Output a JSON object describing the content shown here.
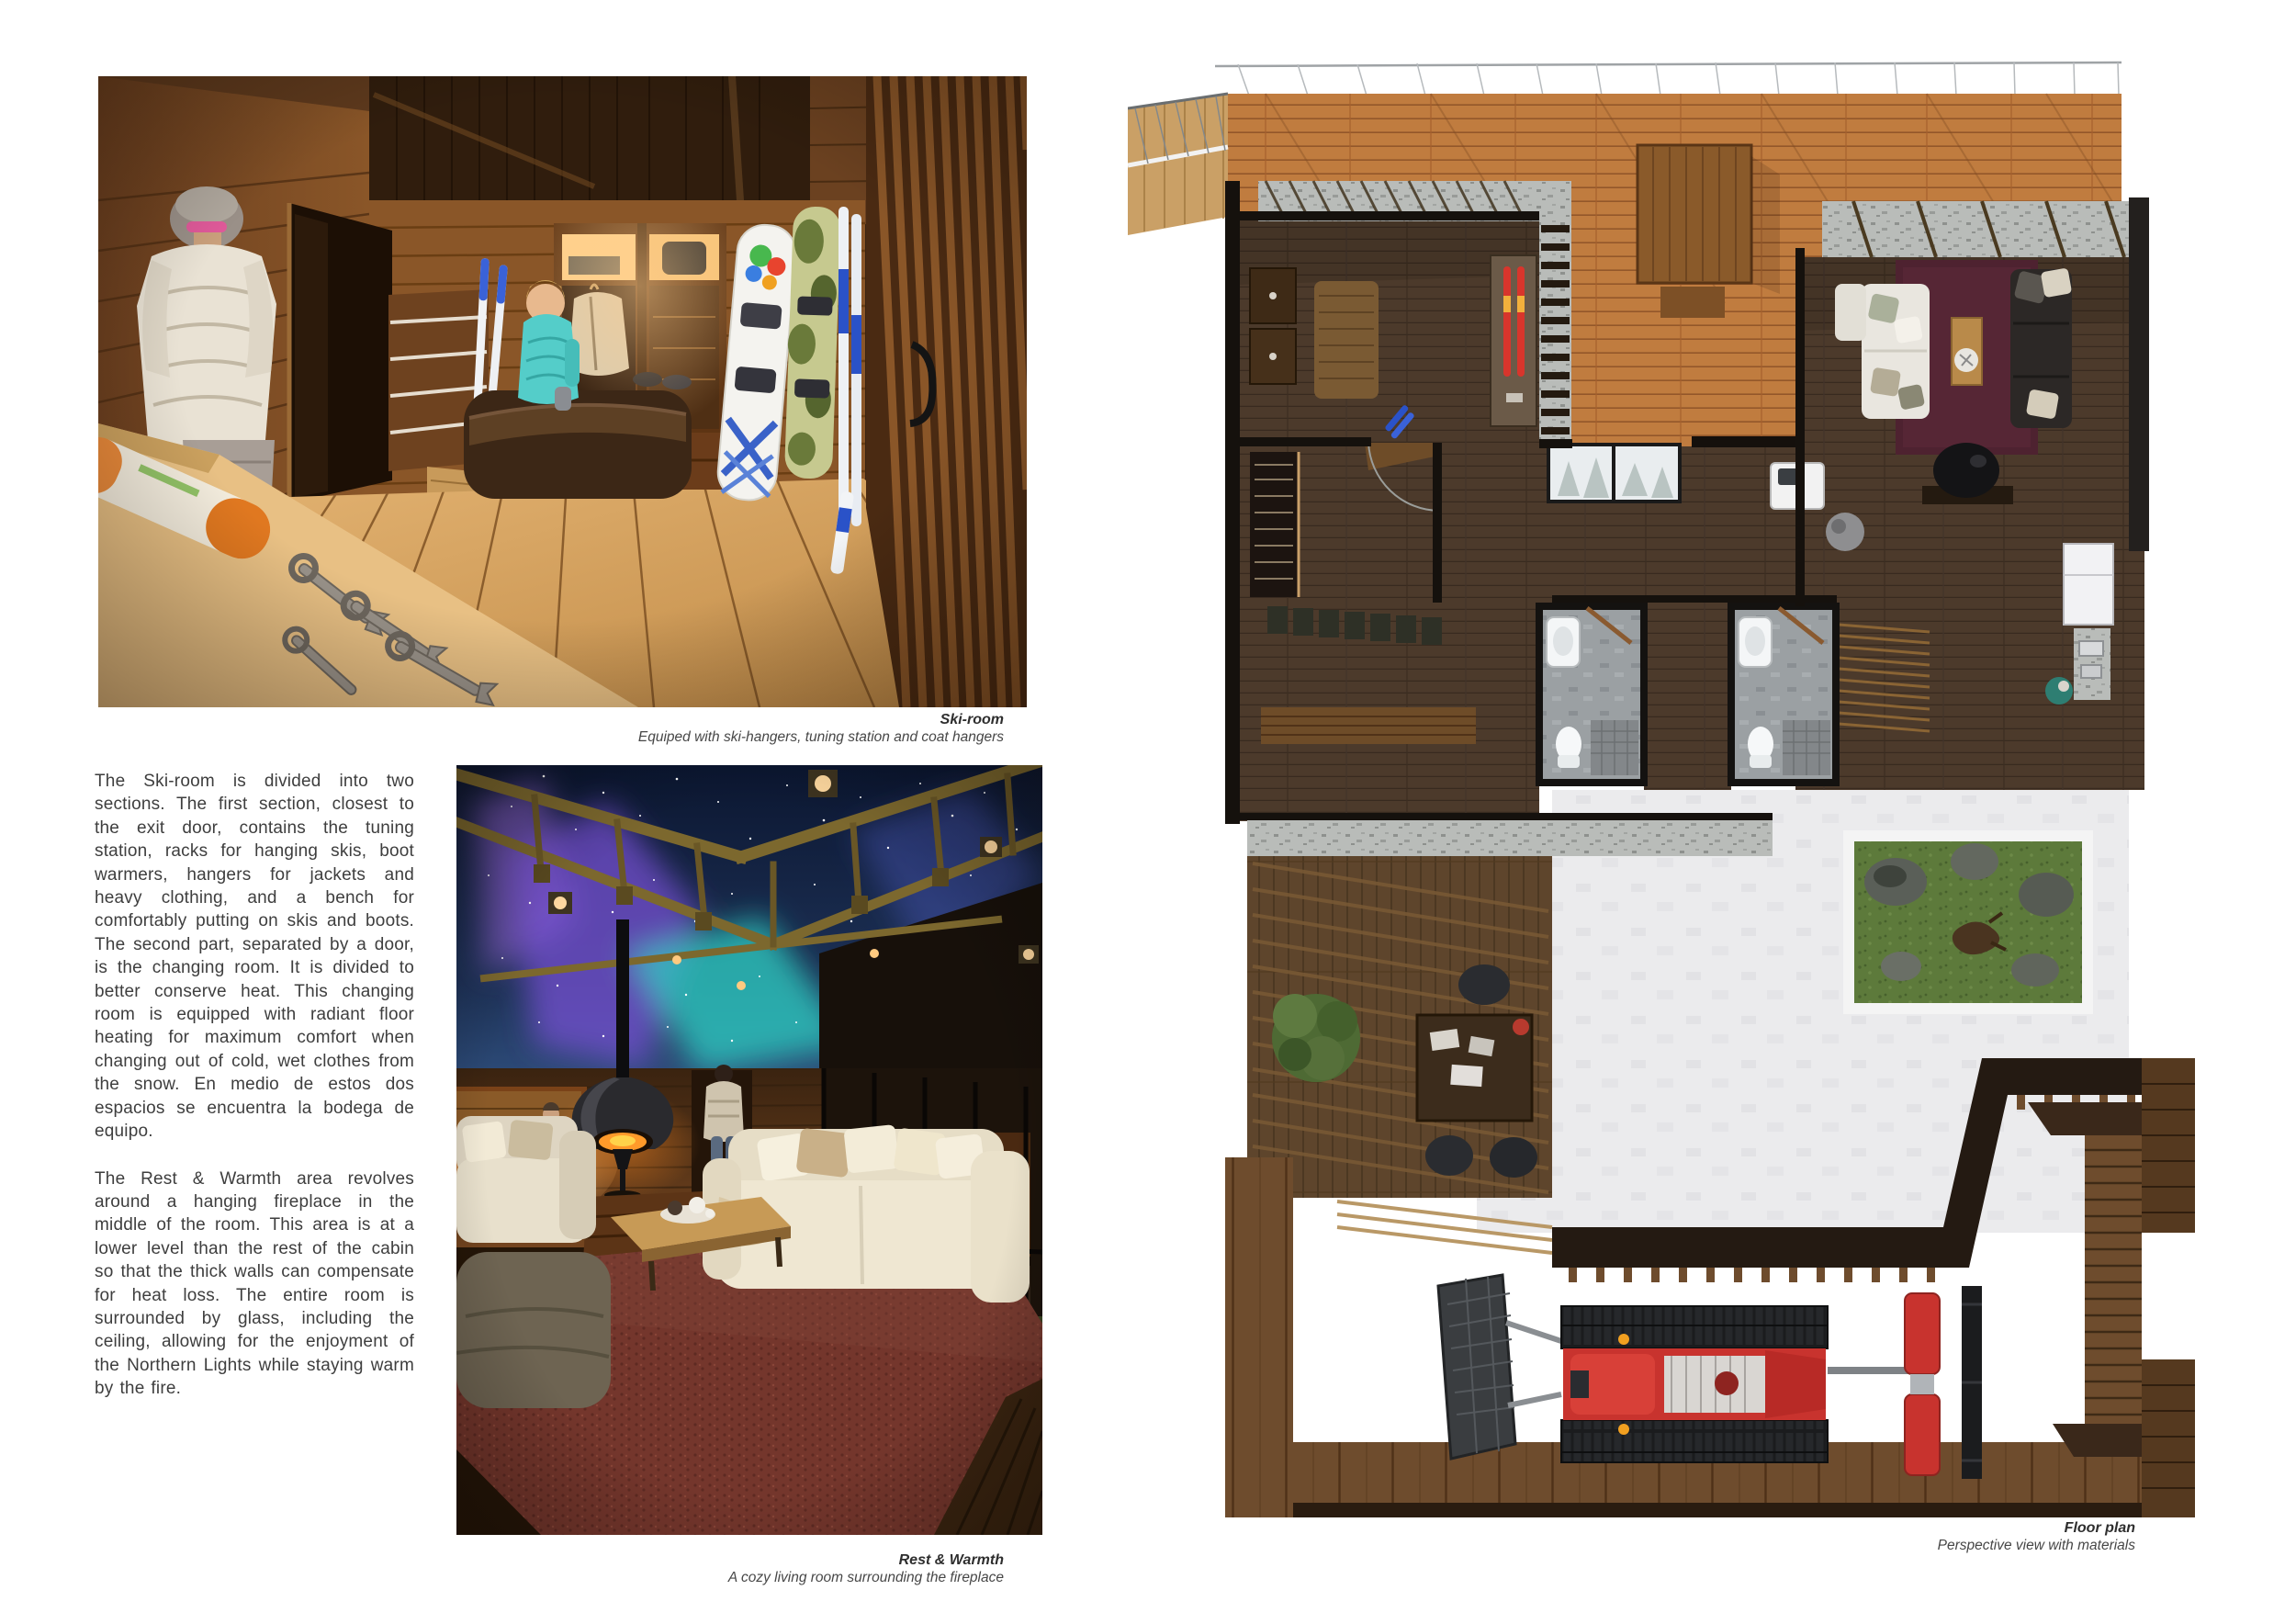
{
  "figures": {
    "ski_room": {
      "caption_title": "Ski-room",
      "caption_subtitle": "Equiped with ski-hangers, tuning station and coat hangers"
    },
    "rest_warmth": {
      "caption_title": "Rest & Warmth",
      "caption_subtitle": "A cozy living room surrounding the fireplace"
    },
    "floor_plan": {
      "caption_title": "Floor plan",
      "caption_subtitle": "Perspective view with materials"
    }
  },
  "body_text": {
    "paragraph_1": "The Ski-room is divided into two sections. The first section, closest to the exit door, contains the tuning station, racks for hanging skis, boot warmers, hangers for jackets and heavy clothing, and a bench for comfortably putting on skis and boots. The second part, separated by a door, is the changing room. It is divided to better conserve heat. This changing room is equipped with radiant floor heating for maximum comfort when changing out of cold, wet clothes from the snow. En medio de estos dos espacios se encuentra la bodega de equipo.",
    "paragraph_2": "The Rest & Warmth area revolves around a hanging fireplace in the middle of the room. This area is at a lower level than the rest of the cabin so that the thick walls can compensate for heat loss. The entire room is surrounded by glass, including the ceiling, allowing for the enjoyment of the Northern Lights while staying warm by the fire."
  },
  "colors": {
    "wood_warm": "#8a5628",
    "wood_deck": "#c07c3f",
    "floor_light": "#d9a860",
    "carpet_maroon": "#74362c",
    "aurora_purple": "#7b52d8",
    "aurora_teal": "#2fd0c4",
    "night_sky": "#16233f",
    "teal_jacket": "#54cdc9",
    "snowcat_red": "#c8332e",
    "garden_green": "#5d7a3b",
    "rug_burgundy": "#4e2230"
  }
}
